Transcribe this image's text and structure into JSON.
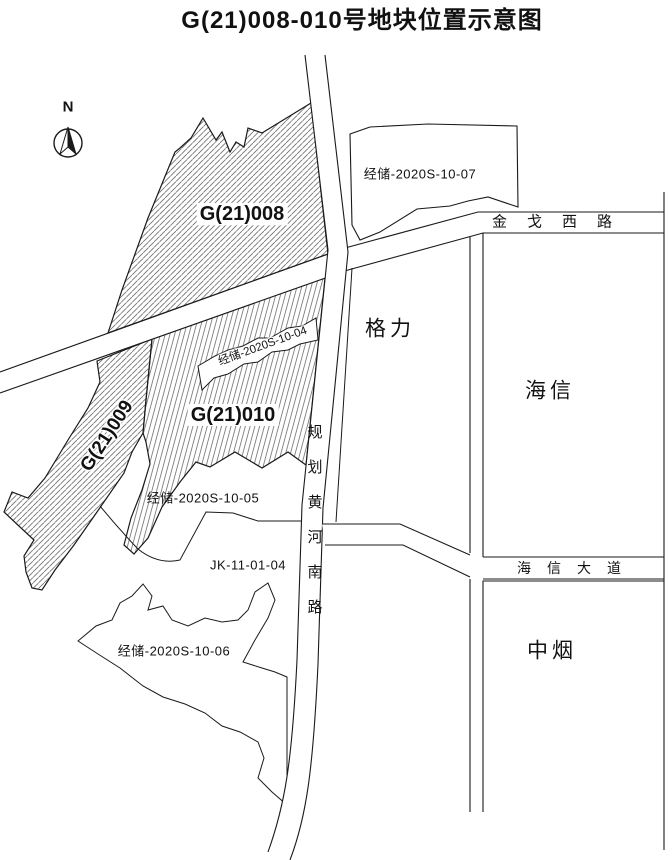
{
  "title": "G(21)008-010号地块位置示意图",
  "compass": {
    "label": "N"
  },
  "parcels": {
    "g008": {
      "label": "G(21)008",
      "style": "hatched-45"
    },
    "g009": {
      "label": "G(21)009",
      "style": "hatched-45"
    },
    "g010": {
      "label": "G(21)010",
      "style": "hatched-steep"
    },
    "jingchu_2020s_10_04": {
      "label": "经储-2020S-10-04"
    },
    "jingchu_2020s_10_05": {
      "label": "经储-2020S-10-05"
    },
    "jingchu_2020s_10_06": {
      "label": "经储-2020S-10-06"
    },
    "jingchu_2020s_10_07": {
      "label": "经储-2020S-10-07"
    },
    "jk_11_01_04": {
      "label": "JK-11-01-04"
    }
  },
  "roads": {
    "jinge_xi_lu": {
      "label": "金戈西路",
      "orientation": "horizontal"
    },
    "guihua_huanghe_nan_lu": {
      "label": "规划黄河南路",
      "orientation": "vertical"
    },
    "haixin_dadao": {
      "label": "海信大道",
      "orientation": "horizontal"
    }
  },
  "landmarks": {
    "geli": {
      "label": "格力"
    },
    "haixin": {
      "label": "海信"
    },
    "zhongyan": {
      "label": "中烟"
    }
  },
  "colors": {
    "line": "#1a1a1a",
    "hatch": "#6e6e6e",
    "background": "#ffffff"
  }
}
